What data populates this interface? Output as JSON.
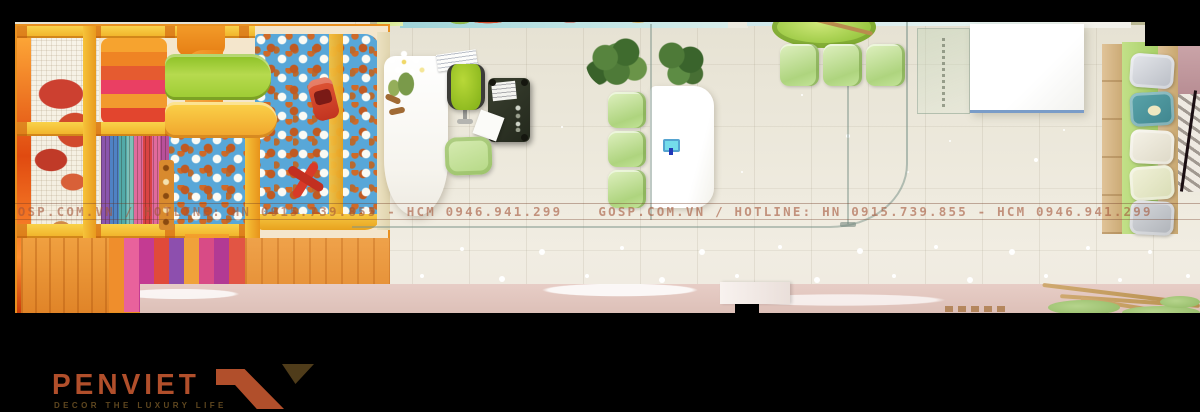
{
  "watermark": {
    "text": "GOSP.COM.VN / HOTLINE: HN 0915.739.855 - HCM 0946.941.299",
    "repeat_count": 2,
    "color": "#a35538"
  },
  "brand": {
    "wordmark": "PENVIET",
    "tagline": "DECOR THE LUXURY LIFE",
    "wordmark_color": "#b14f2b",
    "tagline_color": "#5f471f"
  },
  "palette": {
    "letterbox_black": "#000000",
    "floor_beige": "#ece8db",
    "walkway_pink": "#e0c4bd",
    "lime_green": "#a5cc3d",
    "soft_green": "#c8e4a4",
    "ball_pit_blue": "#58a7d8",
    "ball_orange": "#c05a22",
    "playground_orange": "#f09a28",
    "beam_yellow": "#f6c33a",
    "mural_red": "#cc4430"
  },
  "scene_objects": [
    "indoor-playground",
    "ball-pit",
    "green-slide",
    "yellow-slide",
    "toy-car",
    "toy-plane",
    "reception-counter",
    "cashier-desk",
    "office-chair",
    "guest-armchair",
    "potted-plants",
    "dining-chairs",
    "white-table",
    "glass-partition",
    "round-table",
    "display-cube",
    "bench-sofa",
    "pillows",
    "staircase",
    "walkway",
    "bamboo-decor"
  ]
}
